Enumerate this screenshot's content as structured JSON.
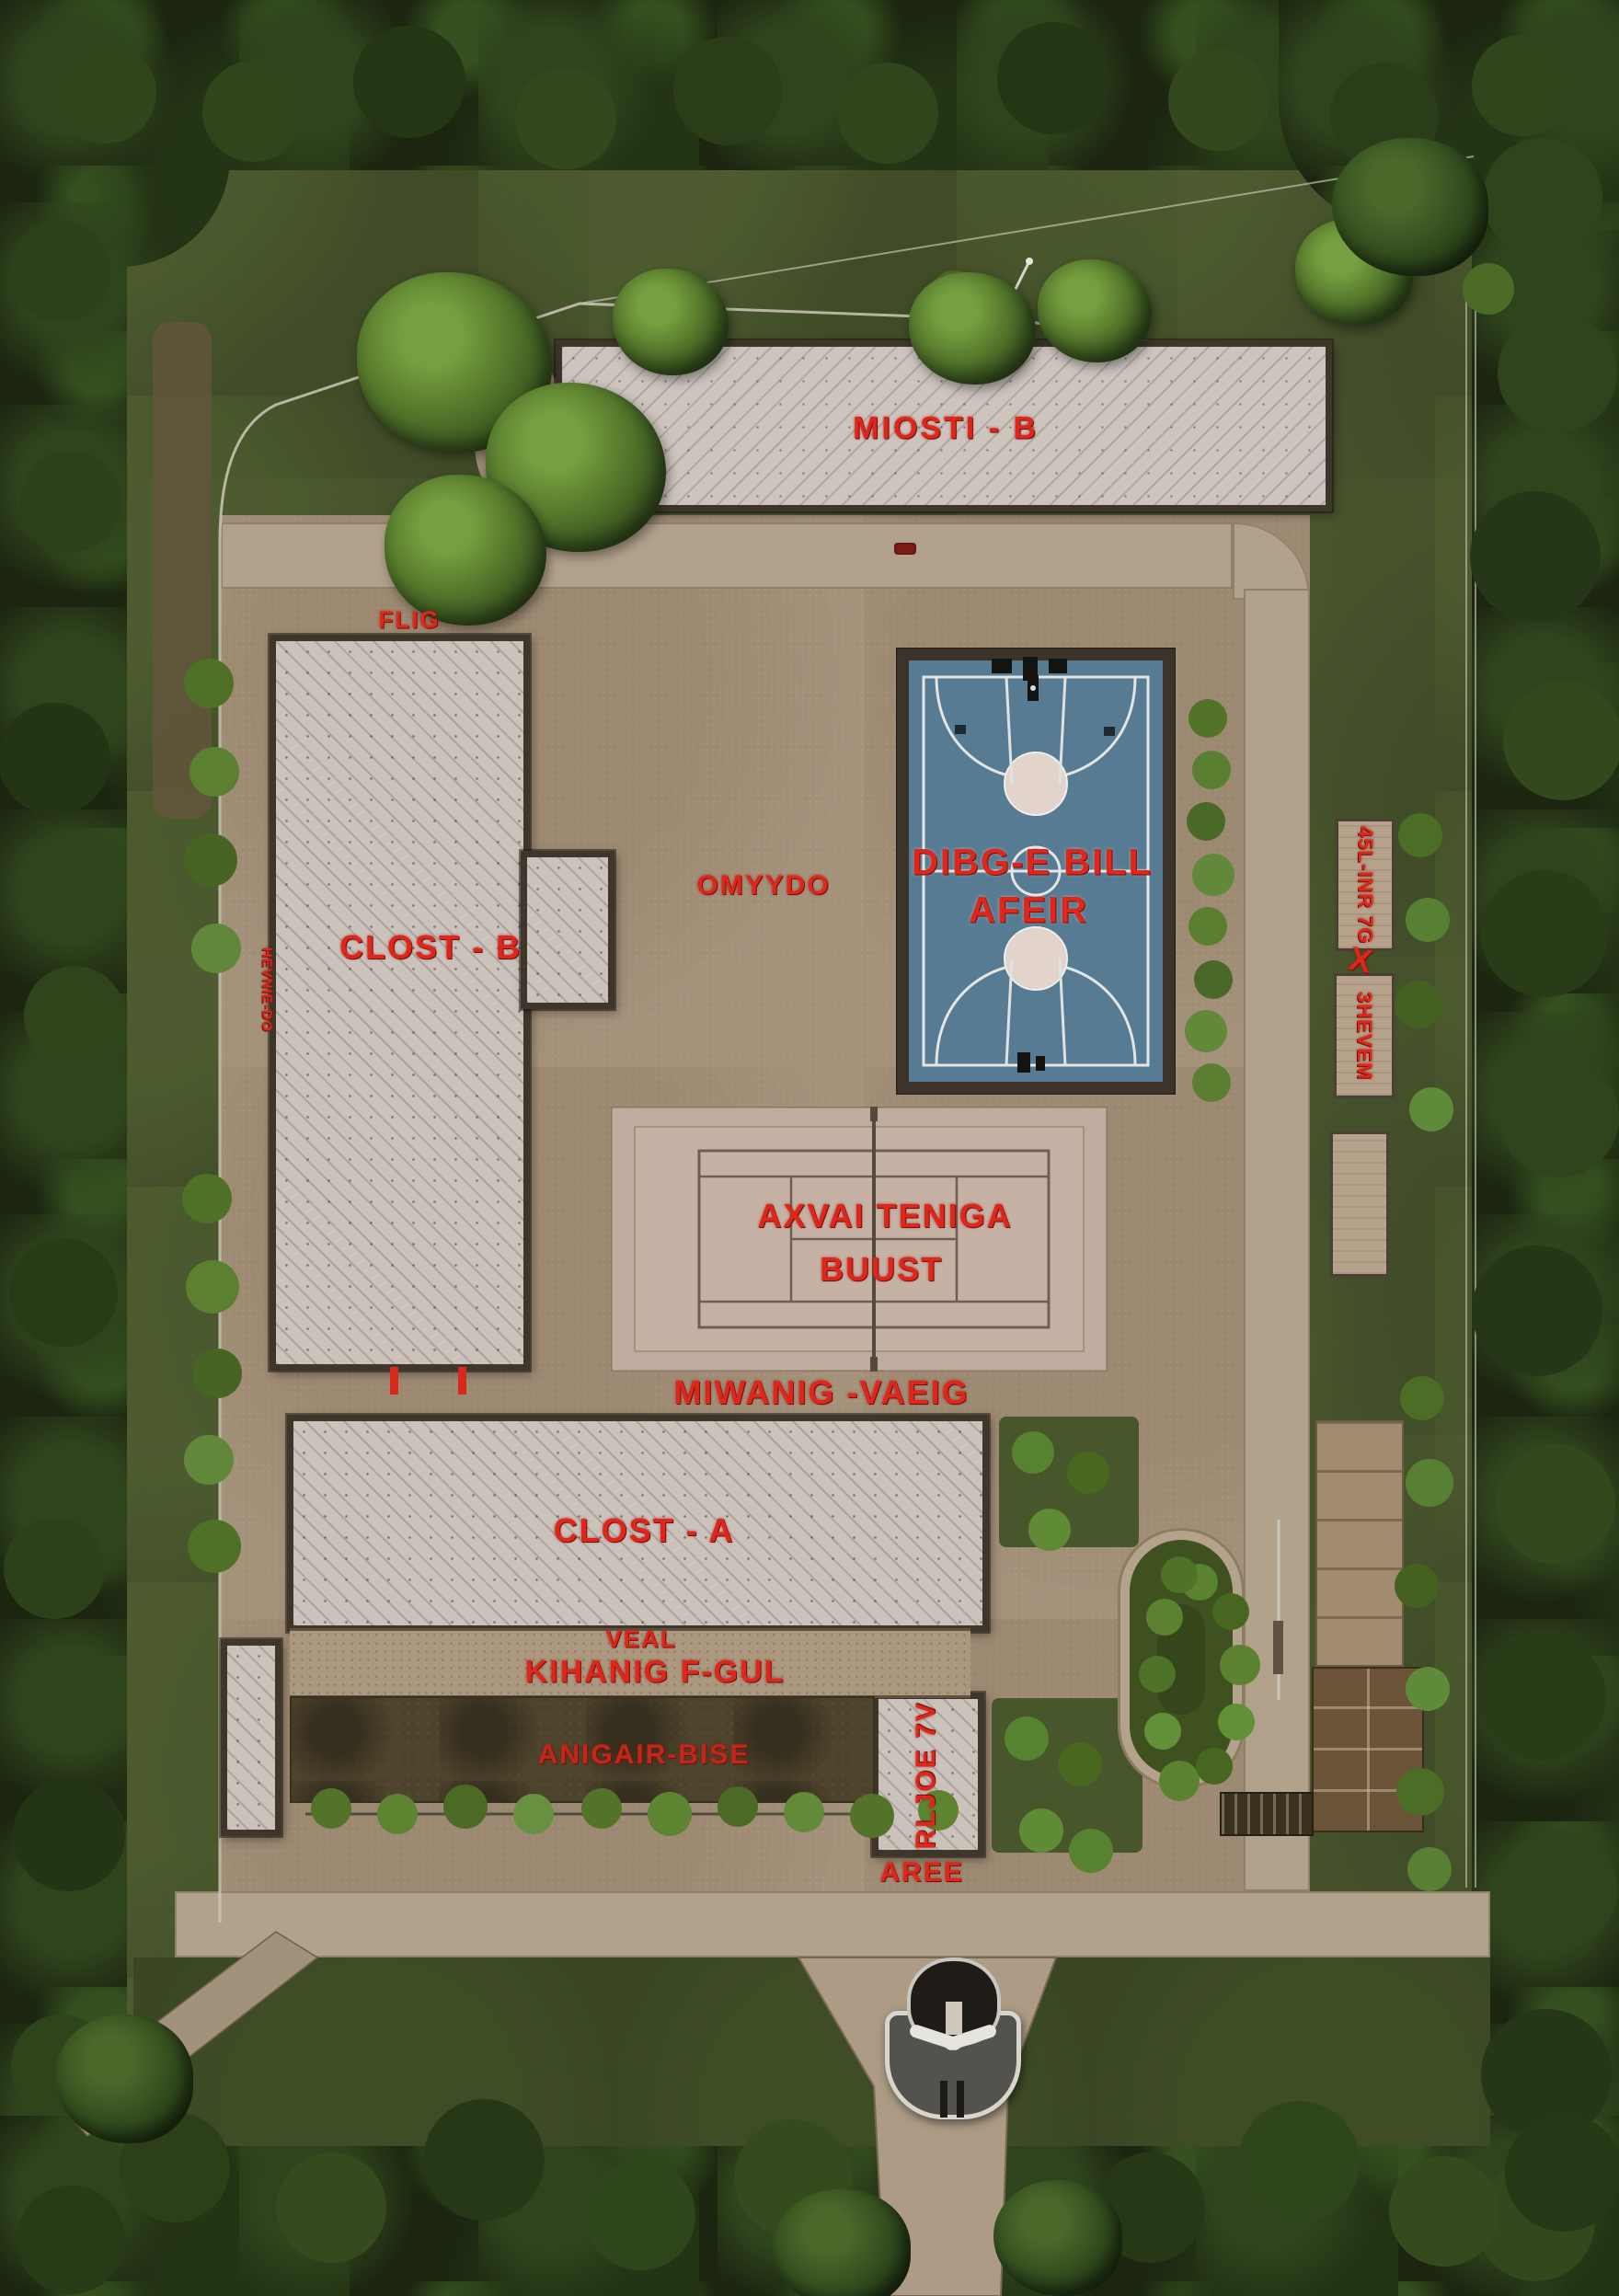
{
  "labels": {
    "building_top": "MIOSTI - B",
    "gate_small": "FLIG",
    "clost_b": "CLOST - B",
    "ground_mid": "OMYYDO",
    "court_line1": "DIBG-E BILL",
    "court_line2": "AFEIR",
    "tennis_line1": "AXVAI TENIGA",
    "tennis_line2": "BUUST",
    "walk_label": "MIWANIG -VAEIG",
    "clost_a": "CLOST - A",
    "veal": "VEAL",
    "kihanig": "KIHANIG F-GUL",
    "garden": "ANIGAIR-BISE",
    "rljoe": "RLJOE 7V",
    "aree": "AREE",
    "left_edge_vertical": "HEVNIE-DO",
    "sign_right_top": "45L-INR 7G",
    "x_marker": "X",
    "sign_right_bottom": "3HEVEM"
  },
  "colors": {
    "label_red": "#e0261b",
    "court_blue": "#577b92",
    "roof_gray": "#cbc2bc",
    "ground_tan": "#a5927b",
    "grass_green": "#46522c",
    "forest_green": "#1b2510"
  }
}
